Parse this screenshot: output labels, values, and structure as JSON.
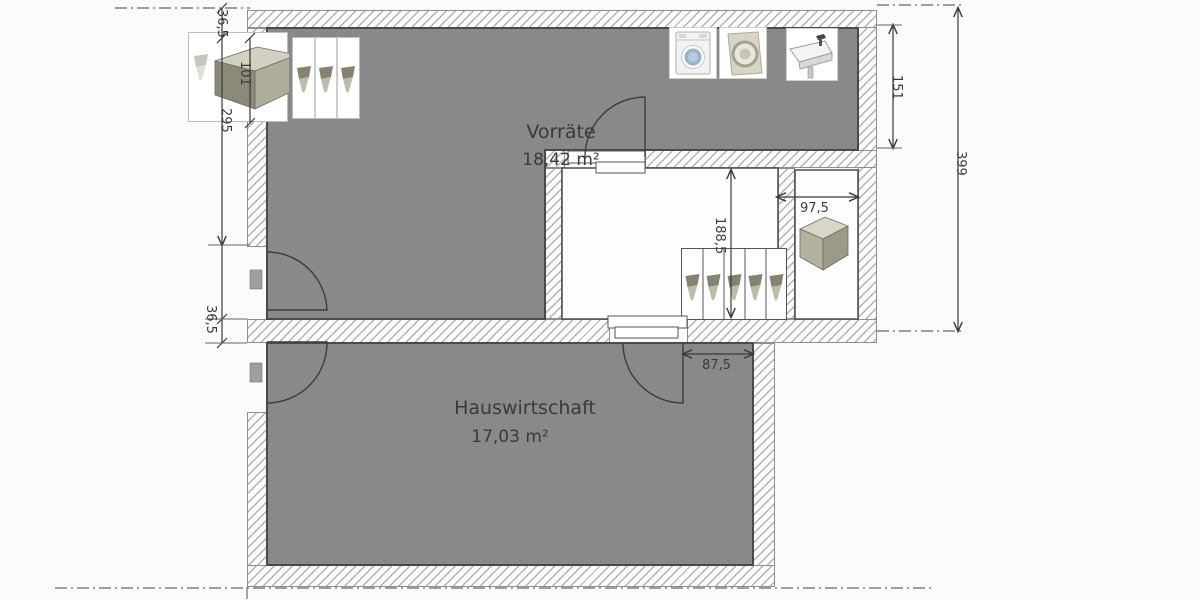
{
  "rooms": [
    {
      "name": "Vorräte",
      "area": "18,42 m²"
    },
    {
      "name": "Hauswirtschaft",
      "area": "17,03 m²"
    }
  ],
  "dimensions": {
    "top_wall_thickness": "36,5",
    "cabinet_run": "101",
    "vorraete_height": "295",
    "middle_wall_thickness": "36,5",
    "right_nook_height": "151",
    "overall_height": "399",
    "storage_depth": "188,5",
    "niche_width": "97,5",
    "door_offset": "87,5"
  },
  "palette": {
    "room_fill": "#898989",
    "room_outline": "#4a4a4a",
    "hatch_line": "#b2b2b2",
    "dimension_color": "#3a3a3a",
    "furniture_olive": "#a9a796",
    "washer_door_blue": "#9db3cc"
  }
}
